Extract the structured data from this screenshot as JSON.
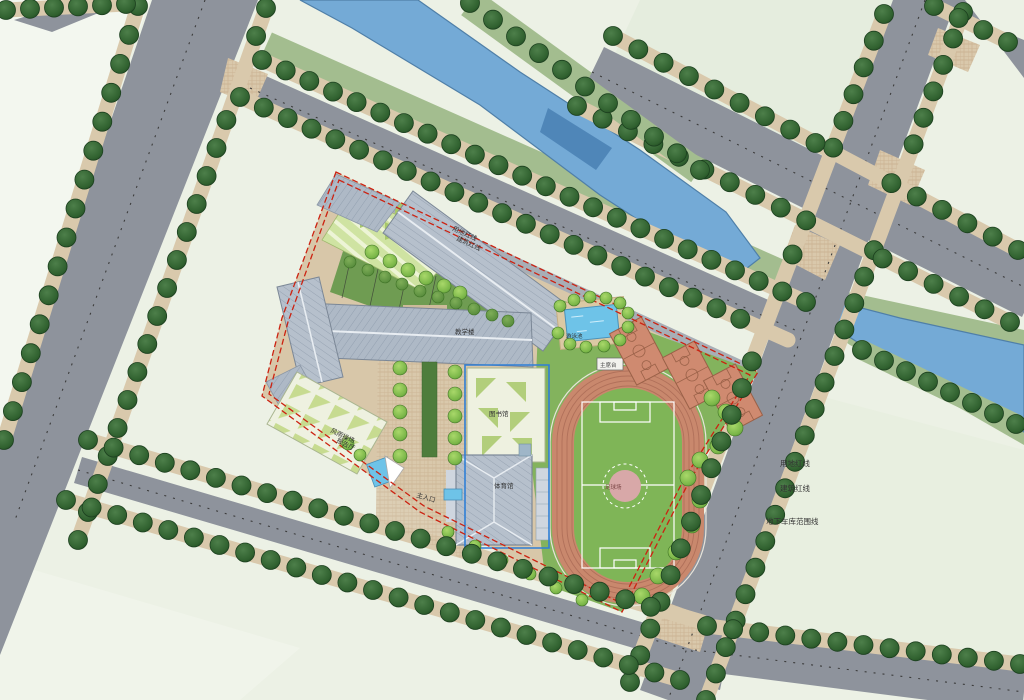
{
  "plan": {
    "type": "school-campus-site-plan",
    "labels": {
      "redline_land": "用地红线",
      "redline_building": "建筑红线",
      "garage_extent": "地下车库范围线",
      "legend_land": "用地红线",
      "legend_building": "建筑红线",
      "legend_garage": "地下车库范围线",
      "teaching_building": "教学楼",
      "gym_hall_1": "风雨操场",
      "gym_hall_2": "报告厅",
      "library": "图书馆",
      "sports_hall": "体育馆",
      "main_entrance": "主入口",
      "pool": "游泳池",
      "podium": "主席台",
      "football_field": "足球场"
    },
    "palette": {
      "field": "#ecf1e5",
      "fieldLight": "#f3f7ef",
      "fieldMid": "#e5edde",
      "fieldBottom": "#f0f4ea",
      "fieldRight": "#e8efe0",
      "road": "#8e939c",
      "sidewalk": "#d9c9ac",
      "bank": "#a3bd8f",
      "river": "#74aad6",
      "riverDark": "#4f86b8",
      "riverEdge": "#4f7fa8",
      "treeDark": "#30612f",
      "treeDarkEdge": "#1c401f",
      "treeBright": "#7ab648",
      "treeMid": "#5b8f3f",
      "lawn": "#83b35d",
      "lawnInfield": "#7fb557",
      "courtyard": "#6f9c52",
      "paving": "#d8c7a9",
      "roof": "#b6c0cc",
      "roofLight": "#cfd6df",
      "ridge": "#e8edf2",
      "track": "#c9886d",
      "trackLine": "#b0705a",
      "court": "#cf8a70",
      "courtLine": "#9a6148",
      "pool": "#6ec3e8",
      "poolEdge": "#4a90b8",
      "terrace": "#cfe3a2",
      "terraceTri": "#a8c86a",
      "facets": "#eef1e0",
      "boundary": "#cc2211",
      "garage": "#2f7fd6",
      "hedge": "#4e7d3c",
      "pitchPink": "#d8a8a8",
      "deck": "#dbc9a4",
      "text": "#333333"
    }
  }
}
